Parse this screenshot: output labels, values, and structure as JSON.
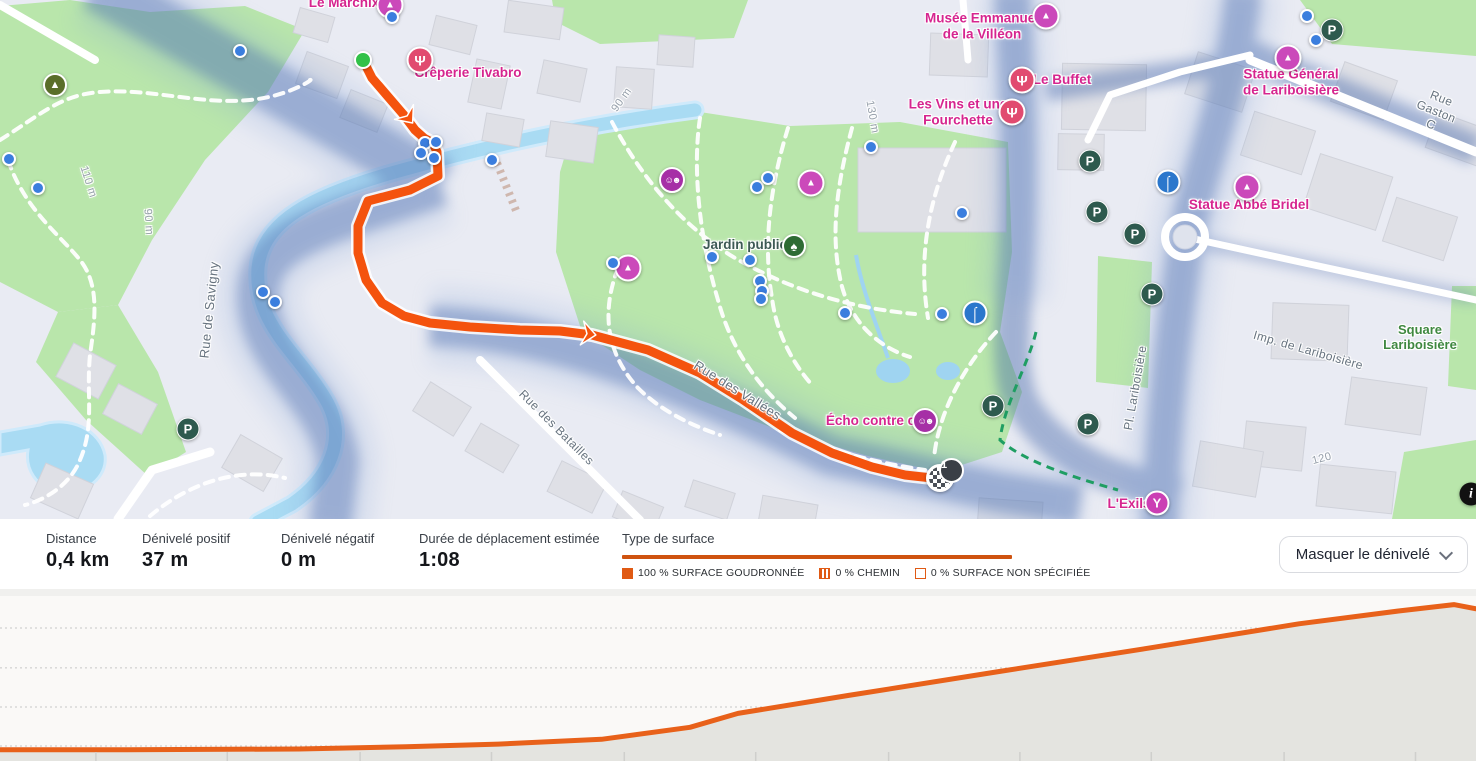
{
  "map": {
    "labels": [
      {
        "name": "poi-label-le-marchix",
        "text": "Le Marchix",
        "kind": "poi",
        "x": 344,
        "y": 3
      },
      {
        "name": "poi-label-creperie-tivabro",
        "text": "Crêperie Tivabro",
        "kind": "poi",
        "x": 468,
        "y": 73
      },
      {
        "name": "poi-label-musee-villeon",
        "text": "Musée Emmanuel\nde la Villéon",
        "kind": "poi",
        "x": 982,
        "y": 26
      },
      {
        "name": "poi-label-le-buffet",
        "text": "Le Buffet",
        "kind": "poi",
        "x": 1062,
        "y": 80
      },
      {
        "name": "poi-label-les-vins",
        "text": "Les Vins et une\nFourchette",
        "kind": "poi",
        "x": 958,
        "y": 112
      },
      {
        "name": "poi-label-statue-general",
        "text": "Statue Général\nde Lariboisière",
        "kind": "poi",
        "x": 1291,
        "y": 82
      },
      {
        "name": "poi-label-statue-abbe-bridel",
        "text": "Statue Abbé Bridel",
        "kind": "poi",
        "x": 1249,
        "y": 205
      },
      {
        "name": "poi-label-echo-contre-ciel",
        "text": "Écho contre ciel",
        "kind": "poi",
        "x": 878,
        "y": 421
      },
      {
        "name": "poi-label-l-exils",
        "text": "L'Exils",
        "kind": "poi",
        "x": 1129,
        "y": 504
      },
      {
        "name": "park-label-jardin-public",
        "text": "Jardin public",
        "kind": "dark",
        "x": 745,
        "y": 245
      },
      {
        "name": "park-label-square-lariboisiere",
        "text": "Square Lariboisière",
        "kind": "park",
        "x": 1420,
        "y": 338
      },
      {
        "name": "street-label-rue-de-savigny",
        "text": "Rue de Savigny",
        "kind": "street",
        "x": 210,
        "y": 310,
        "rot": -84,
        "size": 13
      },
      {
        "name": "street-label-rue-des-batailles",
        "text": "Rue des Batailles",
        "kind": "street",
        "x": 556,
        "y": 428,
        "rot": 45
      },
      {
        "name": "street-label-rue-des-vallees",
        "text": "Rue des Vallées",
        "kind": "street",
        "x": 737,
        "y": 391,
        "rot": 32,
        "size": 13
      },
      {
        "name": "street-label-imp-lariboisiere",
        "text": "Imp. de Lariboisière",
        "kind": "street",
        "x": 1308,
        "y": 351,
        "rot": 16
      },
      {
        "name": "street-label-pl-lariboisiere",
        "text": "Pl. Lariboisière",
        "kind": "street",
        "x": 1136,
        "y": 388,
        "rot": -80
      },
      {
        "name": "street-label-rue-gaston",
        "text": "Rue Gaston C",
        "kind": "street",
        "x": 1436,
        "y": 112,
        "rot": 22
      },
      {
        "name": "contour-label-110m",
        "text": "110 m",
        "kind": "contour",
        "x": 88,
        "y": 182,
        "rot": 72
      },
      {
        "name": "contour-label-90m-left",
        "text": "90 m",
        "kind": "contour",
        "x": 148,
        "y": 222,
        "rot": 86
      },
      {
        "name": "contour-label-90m-mid",
        "text": "90 m",
        "kind": "contour",
        "x": 622,
        "y": 100,
        "rot": -55
      },
      {
        "name": "contour-label-130m",
        "text": "130 m",
        "kind": "contour",
        "x": 872,
        "y": 117,
        "rot": 80
      },
      {
        "name": "contour-label-120",
        "text": "120",
        "kind": "contour",
        "x": 1322,
        "y": 459,
        "rot": -15
      }
    ],
    "markers": [
      {
        "type": "monument",
        "x": 390,
        "y": 5
      },
      {
        "type": "monument",
        "x": 1046,
        "y": 16
      },
      {
        "type": "monument",
        "x": 811,
        "y": 183
      },
      {
        "type": "monument",
        "x": 628,
        "y": 268
      },
      {
        "type": "monument",
        "x": 1288,
        "y": 58
      },
      {
        "type": "monument",
        "x": 1247,
        "y": 187
      },
      {
        "type": "restaurant",
        "x": 420,
        "y": 60
      },
      {
        "type": "restaurant",
        "x": 1022,
        "y": 80
      },
      {
        "type": "restaurant",
        "x": 1012,
        "y": 112
      },
      {
        "type": "masks",
        "x": 672,
        "y": 180
      },
      {
        "type": "masks",
        "x": 925,
        "y": 421
      },
      {
        "type": "cocktail",
        "x": 1157,
        "y": 503
      },
      {
        "type": "tree",
        "x": 794,
        "y": 246
      },
      {
        "type": "mountain",
        "x": 55,
        "y": 85
      },
      {
        "type": "parking",
        "x": 188,
        "y": 429
      },
      {
        "type": "parking",
        "x": 1332,
        "y": 30
      },
      {
        "type": "parking",
        "x": 1090,
        "y": 161
      },
      {
        "type": "parking",
        "x": 1097,
        "y": 212
      },
      {
        "type": "parking",
        "x": 1135,
        "y": 234
      },
      {
        "type": "parking",
        "x": 1152,
        "y": 294
      },
      {
        "type": "parking",
        "x": 993,
        "y": 406
      },
      {
        "type": "parking",
        "x": 1088,
        "y": 424
      },
      {
        "type": "fountain",
        "x": 975,
        "y": 313
      },
      {
        "type": "fountain",
        "x": 1168,
        "y": 182
      },
      {
        "type": "waypoint",
        "x": 392,
        "y": 17
      },
      {
        "type": "waypoint",
        "x": 240,
        "y": 51
      },
      {
        "type": "waypoint",
        "x": 9,
        "y": 159
      },
      {
        "type": "waypoint",
        "x": 38,
        "y": 188
      },
      {
        "type": "waypoint",
        "x": 871,
        "y": 147
      },
      {
        "type": "waypoint",
        "x": 1307,
        "y": 16
      },
      {
        "type": "waypoint",
        "x": 1316,
        "y": 40
      },
      {
        "type": "waypoint",
        "x": 425,
        "y": 143
      },
      {
        "type": "waypoint",
        "x": 436,
        "y": 142
      },
      {
        "type": "waypoint",
        "x": 421,
        "y": 153
      },
      {
        "type": "waypoint",
        "x": 434,
        "y": 158
      },
      {
        "type": "waypoint",
        "x": 492,
        "y": 160
      },
      {
        "type": "waypoint",
        "x": 263,
        "y": 292
      },
      {
        "type": "waypoint",
        "x": 275,
        "y": 302
      },
      {
        "type": "waypoint",
        "x": 613,
        "y": 263
      },
      {
        "type": "waypoint",
        "x": 757,
        "y": 187
      },
      {
        "type": "waypoint",
        "x": 768,
        "y": 178
      },
      {
        "type": "waypoint",
        "x": 712,
        "y": 257
      },
      {
        "type": "waypoint",
        "x": 750,
        "y": 260
      },
      {
        "type": "waypoint",
        "x": 760,
        "y": 281
      },
      {
        "type": "waypoint",
        "x": 762,
        "y": 291
      },
      {
        "type": "waypoint",
        "x": 761,
        "y": 299
      },
      {
        "type": "waypoint",
        "x": 845,
        "y": 313
      },
      {
        "type": "waypoint",
        "x": 942,
        "y": 314
      },
      {
        "type": "waypoint",
        "x": 962,
        "y": 213
      },
      {
        "type": "start",
        "x": 363,
        "y": 60
      },
      {
        "type": "finish",
        "x": 940,
        "y": 478
      },
      {
        "type": "info",
        "x": 1471,
        "y": 494
      }
    ],
    "marker_glyphs": {
      "monument": "▲",
      "restaurant": "Ψ",
      "masks": "☺☻",
      "tree": "♠",
      "mountain": "▲",
      "parking": "P",
      "fountain": "⌠",
      "cocktail": "Y",
      "info": "i"
    },
    "finish_badge": "1",
    "route_color": "#f4530e",
    "poi_color": "#d6258f",
    "waypoint_color": "#3b7ede",
    "start_color": "#31c148",
    "parking_color": "#2e5a4e"
  },
  "stats": {
    "items": [
      {
        "label": "Distance",
        "value": "0,4 km"
      },
      {
        "label": "Dénivelé positif",
        "value": "37 m"
      },
      {
        "label": "Dénivelé négatif",
        "value": "0 m"
      },
      {
        "label": "Durée de déplacement estimée",
        "value": "1:08"
      }
    ],
    "surface": {
      "title": "Type de surface",
      "bar_color": "#cf5310",
      "legend": [
        {
          "label": "100 % SURFACE GOUDRONNÉE",
          "style": "filled"
        },
        {
          "label": "0 % CHEMIN",
          "style": "striped"
        },
        {
          "label": "0 % SURFACE NON SPÉCIFIÉE",
          "style": "empty"
        }
      ]
    },
    "toggle_button": "Masquer le dénivelé"
  },
  "chart_data": {
    "type": "area",
    "title": "",
    "xlabel": "",
    "ylabel": "",
    "x_km": [
      0,
      0.03,
      0.081,
      0.11,
      0.135,
      0.163,
      0.187,
      0.2,
      0.23,
      0.271,
      0.312,
      0.352,
      0.379,
      0.394,
      0.4
    ],
    "elevation_m": [
      85,
      85,
      85.2,
      85.8,
      86.5,
      87.8,
      91,
      94.7,
      99.5,
      105.9,
      112.2,
      118.6,
      122,
      123.7,
      122.6
    ],
    "xlim": [
      0,
      0.4
    ],
    "ylim": [
      82,
      126
    ],
    "line_color": "#e8611a",
    "fill_color": "#e4e4e0",
    "grid": "dotted-horizontal",
    "gridline_y_frac": [
      0.194,
      0.436,
      0.673,
      0.909
    ],
    "x_tick_fracs": [
      0.065,
      0.154,
      0.244,
      0.333,
      0.423,
      0.512,
      0.602,
      0.691,
      0.78,
      0.87,
      0.959
    ],
    "legend_position": "none"
  }
}
